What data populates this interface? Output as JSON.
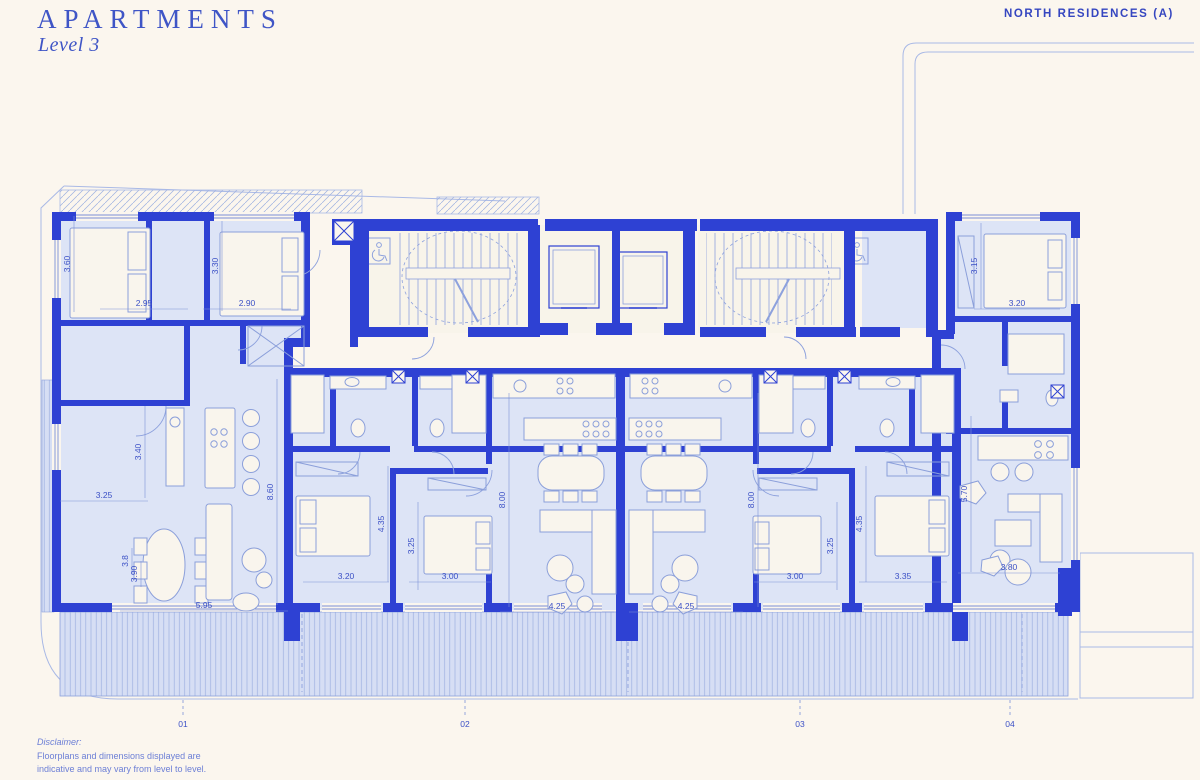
{
  "header": {
    "title": "APARTMENTS",
    "subtitle": "Level 3",
    "project": "NORTH RESIDENCES  (A)"
  },
  "disclaimer": {
    "label": "Disclaimer:",
    "line1": "Floorplans and dimensions displayed are",
    "line2": "indicative and may vary from level to level."
  },
  "colors": {
    "background": "#fbf6ee",
    "wall": "#2e41d3",
    "room_fill": "#dde4f6",
    "core_fill": "#f8f4ea",
    "balcony_fill": "#d6def4",
    "thin_line": "#8da1dd",
    "dimension_text": "#3c51c6",
    "title_text": "#3f55c6"
  },
  "units": [
    {
      "label": "01",
      "x": 183
    },
    {
      "label": "02",
      "x": 465
    },
    {
      "label": "03",
      "x": 800
    },
    {
      "label": "04",
      "x": 1010
    }
  ],
  "dimensions": [
    {
      "text": "3.60",
      "x": 70,
      "y": 264,
      "rot": -90,
      "len": 96
    },
    {
      "text": "2.95",
      "x": 144,
      "y": 306,
      "rot": 0,
      "len": 88
    },
    {
      "text": "3.30",
      "x": 218,
      "y": 266,
      "rot": -90,
      "len": 90
    },
    {
      "text": "2.90",
      "x": 247,
      "y": 306,
      "rot": 0,
      "len": 88
    },
    {
      "text": "3.40",
      "x": 141,
      "y": 452,
      "rot": -90,
      "len": 92
    },
    {
      "text": "3.25",
      "x": 104,
      "y": 498,
      "rot": 0,
      "len": 88
    },
    {
      "text": "8.60",
      "x": 273,
      "y": 492,
      "rot": -90,
      "len": 226
    },
    {
      "text": "3.8",
      "x": 128,
      "y": 561,
      "rot": -90,
      "len": 26
    },
    {
      "text": "3.90",
      "x": 137,
      "y": 574,
      "rot": -90,
      "len": 26
    },
    {
      "text": "5.95",
      "x": 204,
      "y": 608,
      "rot": 0,
      "len": 168
    },
    {
      "text": "4.35",
      "x": 384,
      "y": 524,
      "rot": -90,
      "len": 116
    },
    {
      "text": "3.25",
      "x": 414,
      "y": 546,
      "rot": -90,
      "len": 88
    },
    {
      "text": "3.20",
      "x": 346,
      "y": 579,
      "rot": 0,
      "len": 86
    },
    {
      "text": "3.00",
      "x": 450,
      "y": 579,
      "rot": 0,
      "len": 82
    },
    {
      "text": "8.00",
      "x": 505,
      "y": 500,
      "rot": -90,
      "len": 214
    },
    {
      "text": "4.25",
      "x": 557,
      "y": 609,
      "rot": 0,
      "len": 114
    },
    {
      "text": "8.00",
      "x": 754,
      "y": 500,
      "rot": -90,
      "len": 214
    },
    {
      "text": "4.25",
      "x": 686,
      "y": 609,
      "rot": 0,
      "len": 114
    },
    {
      "text": "3.25",
      "x": 833,
      "y": 546,
      "rot": -90,
      "len": 88
    },
    {
      "text": "4.35",
      "x": 862,
      "y": 524,
      "rot": -90,
      "len": 116
    },
    {
      "text": "3.00",
      "x": 795,
      "y": 579,
      "rot": 0,
      "len": 82
    },
    {
      "text": "3.35",
      "x": 903,
      "y": 579,
      "rot": 0,
      "len": 88
    },
    {
      "text": "3.15",
      "x": 977,
      "y": 266,
      "rot": -90,
      "len": 86
    },
    {
      "text": "3.20",
      "x": 1017,
      "y": 306,
      "rot": 0,
      "len": 86
    },
    {
      "text": "5.70",
      "x": 967,
      "y": 494,
      "rot": -90,
      "len": 156
    },
    {
      "text": "3.80",
      "x": 1009,
      "y": 570,
      "rot": 0,
      "len": 102
    }
  ]
}
